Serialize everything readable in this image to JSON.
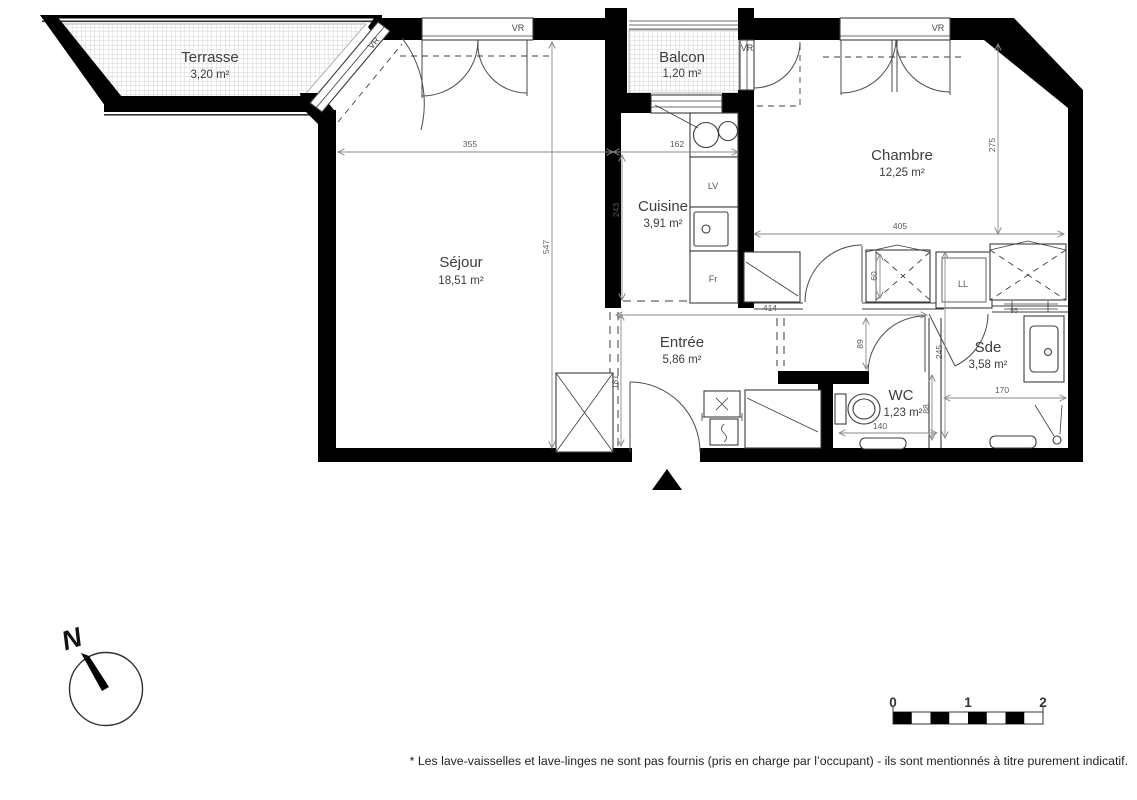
{
  "rooms": [
    {
      "name": "Terrasse",
      "area": "3,20 m²"
    },
    {
      "name": "Balcon",
      "area": "1,20 m²"
    },
    {
      "name": "Chambre",
      "area": "12,25 m²"
    },
    {
      "name": "Cuisine",
      "area": "3,91 m²"
    },
    {
      "name": "Séjour",
      "area": "18,51 m²"
    },
    {
      "name": "Entrée",
      "area": "5,86 m²"
    },
    {
      "name": "WC",
      "area": "1,23 m²"
    },
    {
      "name": "Sde",
      "area": "3,58 m²"
    }
  ],
  "dims": {
    "sejour_width": "355",
    "cuisine_width": "162",
    "sejour_height": "547",
    "cuisine_height": "243",
    "chambre_width": "405",
    "chambre_height": "275",
    "entree_width": "414",
    "hall_clearance": "89",
    "sde_height": "245",
    "entree_height": "181",
    "wc_width": "140",
    "wc_height": "88",
    "sde_width": "170",
    "closet_depth": "60",
    "radiator": "55"
  },
  "labels": {
    "window_shutter": "VR",
    "dishwasher": "LV",
    "fridge": "Fr",
    "washer": "LL"
  },
  "compass": {
    "north": "N"
  },
  "scale_bar": {
    "t0": "0",
    "t1": "1",
    "t2": "2"
  },
  "footnote": "* Les lave-vaisselles et lave-linges ne sont pas fournis (pris en charge par l’occupant) - ils sont mentionnés à titre purement indicatif."
}
